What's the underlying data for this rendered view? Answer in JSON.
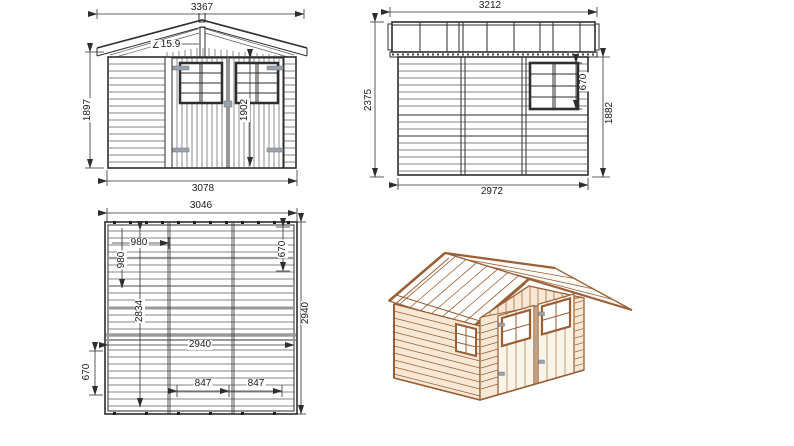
{
  "sheet": {
    "title": "Garden shed technical drawing",
    "background": "#ffffff"
  },
  "colors": {
    "drawing_line": "#2e2e2e",
    "dimension_text": "#1c1c1c",
    "wood_line": "#9a5f35",
    "wood_fill": "#f6e8d5",
    "door_fill": "#fbf4e8",
    "roof_fill": "#ffffff",
    "hinge_gray": "#9aa3ad"
  },
  "views": {
    "front_elevation": {
      "width_top": "3367",
      "angle_icon": "∠",
      "roof_angle": "15.9",
      "height_left": "1897",
      "door_height": "1902",
      "width_bottom": "3078"
    },
    "side_elevation": {
      "width_top": "3212",
      "height_left": "2375",
      "window_height": "670",
      "wall_height_right": "1882",
      "width_bottom": "2972"
    },
    "floor_plan": {
      "width_top": "3046",
      "offset_left_horizontal": "980",
      "offset_left_vertical": "980",
      "window_offset_right": "670",
      "inner_depth": "2834",
      "depth_right": "2940",
      "inner_width": "2940",
      "offset_bottom_left": "670",
      "door_segment_1": "847",
      "door_segment_2": "847"
    },
    "iso_view": {
      "description": "3D perspective of wooden shed"
    }
  }
}
